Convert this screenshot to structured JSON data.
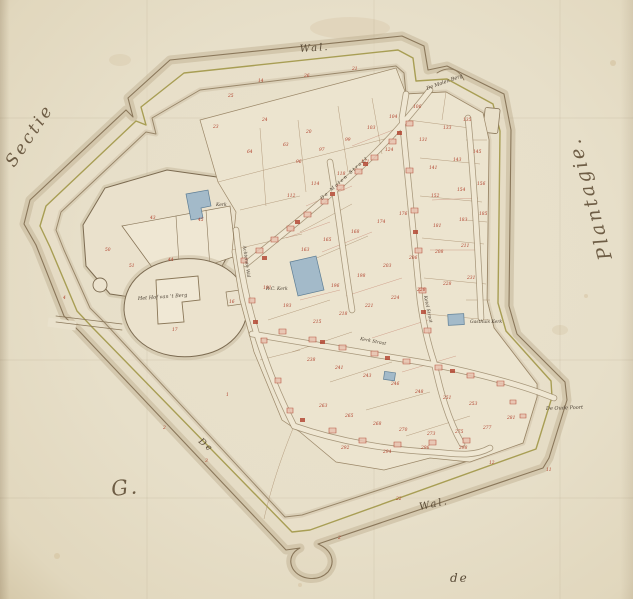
{
  "map": {
    "colors": {
      "paper": "#e9e1cc",
      "field": "#ece4cf",
      "ink": "#6e5d45",
      "line_sepia": "#8a775a",
      "olive": "#a89e54",
      "shade": "#bcac8e",
      "red": "#b0402c",
      "blue": "#a3bac9",
      "blue_stroke": "#5e7e95"
    },
    "labels": [
      {
        "id": "sectie",
        "text": "Sectie",
        "x": 14,
        "y": 168,
        "rot": -56,
        "size": 17,
        "cls": "script-xl",
        "ls": 3
      },
      {
        "id": "plantagie",
        "text": "Plantagie.",
        "x": 612,
        "y": 258,
        "rot": -105,
        "size": 19,
        "cls": "script-xl",
        "ls": 4
      },
      {
        "id": "g-section",
        "text": "G.",
        "x": 112,
        "y": 496,
        "rot": -6,
        "size": 21,
        "cls": "script-xl"
      },
      {
        "id": "wal-top",
        "text": "Wal.",
        "x": 300,
        "y": 52,
        "rot": -4,
        "size": 10,
        "cls": "script"
      },
      {
        "id": "wal-bottom",
        "text": "Wal.",
        "x": 420,
        "y": 510,
        "rot": -12,
        "size": 10,
        "cls": "script"
      },
      {
        "id": "de-wall",
        "text": "De",
        "x": 198,
        "y": 442,
        "rot": 40,
        "size": 9,
        "cls": "script"
      },
      {
        "id": "de-bottom",
        "text": "de",
        "x": 450,
        "y": 582,
        "rot": 0,
        "size": 12,
        "cls": "script"
      },
      {
        "id": "molen-berg",
        "text": "De Molen Berg",
        "x": 427,
        "y": 90,
        "rot": -20,
        "size": 5,
        "cls": "tiny"
      },
      {
        "id": "hof-van-t-berg",
        "text": "Het Hof van 't Berg",
        "x": 138,
        "y": 300,
        "rot": -4,
        "size": 5,
        "cls": "tiny"
      },
      {
        "id": "kerk",
        "text": "Kerk",
        "x": 216,
        "y": 206,
        "rot": 0,
        "size": 4.5,
        "cls": "tiny"
      },
      {
        "id": "rc-kerk",
        "text": "R.C. Kerk",
        "x": 266,
        "y": 290,
        "rot": 0,
        "size": 4.5,
        "cls": "tiny"
      },
      {
        "id": "gasthuis-kerk",
        "text": "Gasthuis Kerk",
        "x": 470,
        "y": 323,
        "rot": 0,
        "size": 4.5,
        "cls": "tiny"
      },
      {
        "id": "oude-poort",
        "text": "De Oude Poort",
        "x": 546,
        "y": 410,
        "rot": -2,
        "size": 5,
        "cls": "tiny"
      },
      {
        "id": "molen-straat",
        "text": "De Molen Straat",
        "x": 322,
        "y": 200,
        "rot": -42,
        "size": 4.8,
        "cls": "tiny",
        "ls": 1.5
      },
      {
        "id": "achterste-wal",
        "text": "Achterste Wal",
        "x": 243,
        "y": 246,
        "rot": 82,
        "size": 4.5,
        "cls": "tiny"
      },
      {
        "id": "ketel-straat",
        "text": "Ketel Straat",
        "x": 424,
        "y": 296,
        "rot": 78,
        "size": 4.5,
        "cls": "tiny"
      },
      {
        "id": "kerk-straat",
        "text": "Kerk Straat",
        "x": 360,
        "y": 340,
        "rot": 11,
        "size": 4.5,
        "cls": "tiny"
      }
    ],
    "parcel_numbers": [
      [
        213,
        128,
        "23"
      ],
      [
        262,
        121,
        "24"
      ],
      [
        247,
        153,
        "64"
      ],
      [
        283,
        146,
        "63"
      ],
      [
        306,
        133,
        "20"
      ],
      [
        228,
        97,
        "25"
      ],
      [
        258,
        82,
        "14"
      ],
      [
        304,
        77,
        "26"
      ],
      [
        352,
        70,
        "21"
      ],
      [
        296,
        163,
        "96"
      ],
      [
        319,
        151,
        "97"
      ],
      [
        345,
        141,
        "99"
      ],
      [
        367,
        129,
        "103"
      ],
      [
        389,
        118,
        "104"
      ],
      [
        413,
        108,
        "106"
      ],
      [
        287,
        197,
        "112"
      ],
      [
        311,
        185,
        "114"
      ],
      [
        337,
        175,
        "118"
      ],
      [
        361,
        163,
        "121"
      ],
      [
        385,
        151,
        "124"
      ],
      [
        419,
        141,
        "131"
      ],
      [
        443,
        129,
        "133"
      ],
      [
        463,
        121,
        "135"
      ],
      [
        429,
        169,
        "141"
      ],
      [
        453,
        161,
        "143"
      ],
      [
        473,
        153,
        "145"
      ],
      [
        431,
        197,
        "152"
      ],
      [
        457,
        191,
        "154"
      ],
      [
        477,
        185,
        "156"
      ],
      [
        301,
        251,
        "163"
      ],
      [
        323,
        241,
        "165"
      ],
      [
        351,
        233,
        "168"
      ],
      [
        377,
        223,
        "174"
      ],
      [
        399,
        215,
        "176"
      ],
      [
        433,
        227,
        "181"
      ],
      [
        459,
        221,
        "183"
      ],
      [
        479,
        215,
        "185"
      ],
      [
        263,
        289,
        "191"
      ],
      [
        283,
        307,
        "193"
      ],
      [
        331,
        287,
        "196"
      ],
      [
        357,
        277,
        "198"
      ],
      [
        383,
        267,
        "203"
      ],
      [
        409,
        259,
        "206"
      ],
      [
        435,
        253,
        "208"
      ],
      [
        461,
        247,
        "211"
      ],
      [
        313,
        323,
        "215"
      ],
      [
        339,
        315,
        "218"
      ],
      [
        365,
        307,
        "221"
      ],
      [
        391,
        299,
        "224"
      ],
      [
        417,
        291,
        "226"
      ],
      [
        443,
        285,
        "228"
      ],
      [
        467,
        279,
        "231"
      ],
      [
        307,
        361,
        "238"
      ],
      [
        335,
        369,
        "241"
      ],
      [
        363,
        377,
        "243"
      ],
      [
        391,
        385,
        "246"
      ],
      [
        415,
        393,
        "248"
      ],
      [
        443,
        399,
        "251"
      ],
      [
        469,
        405,
        "253"
      ],
      [
        319,
        407,
        "263"
      ],
      [
        345,
        417,
        "265"
      ],
      [
        373,
        425,
        "268"
      ],
      [
        399,
        431,
        "270"
      ],
      [
        427,
        435,
        "273"
      ],
      [
        455,
        433,
        "275"
      ],
      [
        483,
        429,
        "277"
      ],
      [
        507,
        419,
        "281"
      ],
      [
        341,
        449,
        "292"
      ],
      [
        383,
        453,
        "294"
      ],
      [
        421,
        449,
        "296"
      ],
      [
        459,
        449,
        "298"
      ],
      [
        150,
        219,
        "43"
      ],
      [
        198,
        221,
        "45"
      ],
      [
        168,
        261,
        "44"
      ],
      [
        129,
        267,
        "51"
      ],
      [
        105,
        251,
        "50"
      ],
      [
        172,
        331,
        "17"
      ],
      [
        229,
        303,
        "16"
      ],
      [
        226,
        396,
        "1"
      ],
      [
        163,
        429,
        "2"
      ],
      [
        205,
        462,
        "3"
      ],
      [
        396,
        500,
        "22"
      ],
      [
        338,
        539,
        "2"
      ],
      [
        489,
        464,
        "12"
      ],
      [
        546,
        471,
        "11"
      ],
      [
        63,
        299,
        "4"
      ]
    ]
  }
}
